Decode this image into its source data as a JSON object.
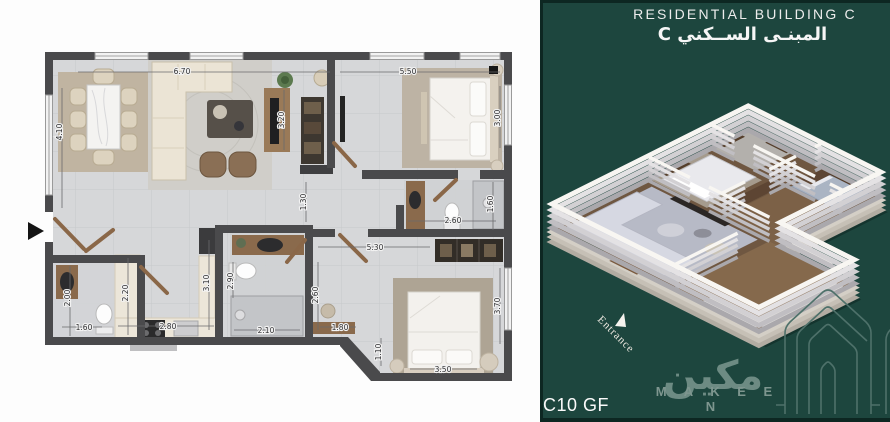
{
  "right_panel": {
    "title_en": "RESIDENTIAL  BUILDING C",
    "title_ar": "المبنـى الســكني C",
    "unit": "C10 GF",
    "entrance": "Entrance",
    "brand_en": "M A K E E N",
    "brand_ar": "مكين",
    "colors": {
      "panel": "#1d463e",
      "panel_edge": "#0d2722",
      "brand": "#7e968f",
      "arch_logo": "#4e716a"
    }
  },
  "plan": {
    "colors": {
      "wall": "#4a4a4c",
      "tile": "#d7d8da",
      "wood": "#8a6a4c",
      "counter": "#ece6d9"
    },
    "entrance_marker": "black-right-arrow",
    "dims": [
      {
        "v": "6.70",
        "x": 182,
        "y": 74,
        "rot": 0
      },
      {
        "v": "5.50",
        "x": 408,
        "y": 74,
        "rot": 0
      },
      {
        "v": "4.10",
        "x": 62,
        "y": 132,
        "rot": -90
      },
      {
        "v": "3.20",
        "x": 284,
        "y": 120,
        "rot": -90
      },
      {
        "v": "3.00",
        "x": 500,
        "y": 118,
        "rot": -90
      },
      {
        "v": "1.30",
        "x": 306,
        "y": 202,
        "rot": -90
      },
      {
        "v": "2.60",
        "x": 453,
        "y": 223,
        "rot": 0
      },
      {
        "v": "1.60",
        "x": 493,
        "y": 204,
        "rot": -90
      },
      {
        "v": "5.30",
        "x": 375,
        "y": 250,
        "rot": 0
      },
      {
        "v": "2.90",
        "x": 233,
        "y": 281,
        "rot": -90
      },
      {
        "v": "2.10",
        "x": 266,
        "y": 333,
        "rot": 0
      },
      {
        "v": "2.60",
        "x": 318,
        "y": 295,
        "rot": -90
      },
      {
        "v": "1.80",
        "x": 340,
        "y": 330,
        "rot": 0
      },
      {
        "v": "1.10",
        "x": 381,
        "y": 352,
        "rot": -90
      },
      {
        "v": "3.50",
        "x": 443,
        "y": 372,
        "rot": 0
      },
      {
        "v": "3.70",
        "x": 500,
        "y": 306,
        "rot": -90
      },
      {
        "v": "2.00",
        "x": 70,
        "y": 298,
        "rot": -90
      },
      {
        "v": "1.60",
        "x": 84,
        "y": 330,
        "rot": 0
      },
      {
        "v": "2.20",
        "x": 128,
        "y": 293,
        "rot": -90
      },
      {
        "v": "2.80",
        "x": 168,
        "y": 329,
        "rot": 0
      },
      {
        "v": "3.10",
        "x": 209,
        "y": 283,
        "rot": -90
      }
    ]
  }
}
